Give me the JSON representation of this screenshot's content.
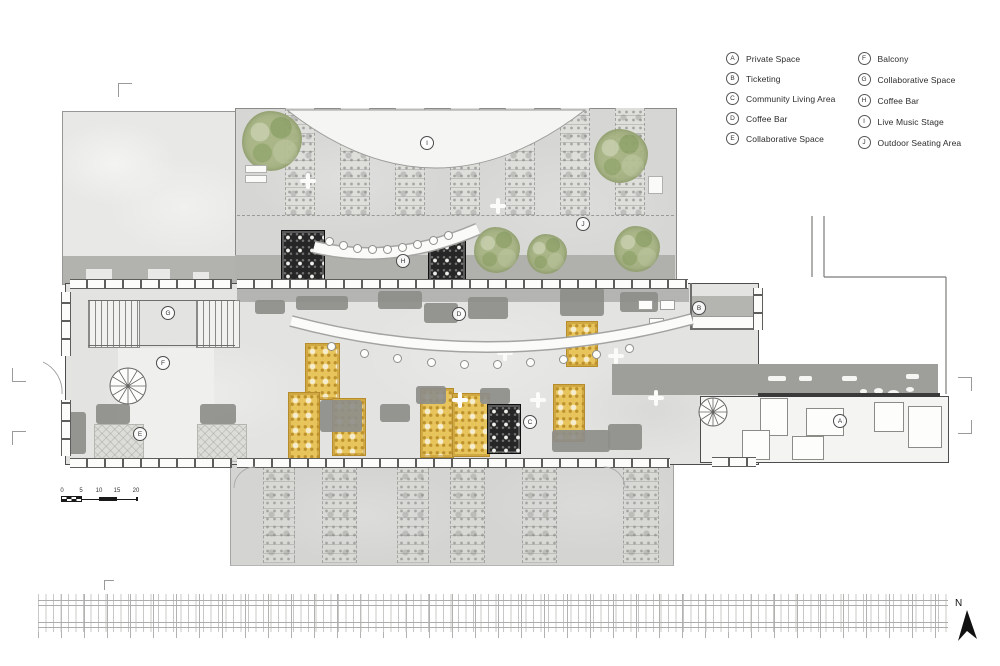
{
  "legend": {
    "column1": [
      {
        "key": "A",
        "label": "Private Space"
      },
      {
        "key": "B",
        "label": "Ticketing"
      },
      {
        "key": "C",
        "label": "Community Living Area"
      },
      {
        "key": "D",
        "label": "Coffee Bar"
      },
      {
        "key": "E",
        "label": "Collaborative Space"
      }
    ],
    "column2": [
      {
        "key": "F",
        "label": "Balcony"
      },
      {
        "key": "G",
        "label": "Collaborative Space"
      },
      {
        "key": "H",
        "label": "Coffee Bar"
      },
      {
        "key": "I",
        "label": "Live Music Stage"
      },
      {
        "key": "J",
        "label": "Outdoor Seating Area"
      }
    ]
  },
  "plan_markers": [
    {
      "key": "A",
      "x": 840,
      "y": 421
    },
    {
      "key": "B",
      "x": 699,
      "y": 308
    },
    {
      "key": "C",
      "x": 530,
      "y": 422
    },
    {
      "key": "D",
      "x": 459,
      "y": 314
    },
    {
      "key": "E",
      "x": 140,
      "y": 434
    },
    {
      "key": "F",
      "x": 163,
      "y": 363
    },
    {
      "key": "G",
      "x": 168,
      "y": 313
    },
    {
      "key": "H",
      "x": 403,
      "y": 261
    },
    {
      "key": "I",
      "x": 427,
      "y": 143
    },
    {
      "key": "J",
      "x": 583,
      "y": 224
    }
  ],
  "scale_bar": {
    "ticks": [
      "0",
      "5",
      "10",
      "15",
      "20"
    ]
  },
  "north_arrow": {
    "label": "N"
  },
  "colors": {
    "outdoor_gray": "#d6d6d4",
    "terrace_dark_band": "#b0b0ad",
    "building_interior": "#e3e3e1",
    "walkway_dark": "#9e9e9b",
    "rug_yellow": "#e8c55c",
    "rug_black": "#262626",
    "tree_green": "#a7b482",
    "wall": "#4d4d4d"
  }
}
